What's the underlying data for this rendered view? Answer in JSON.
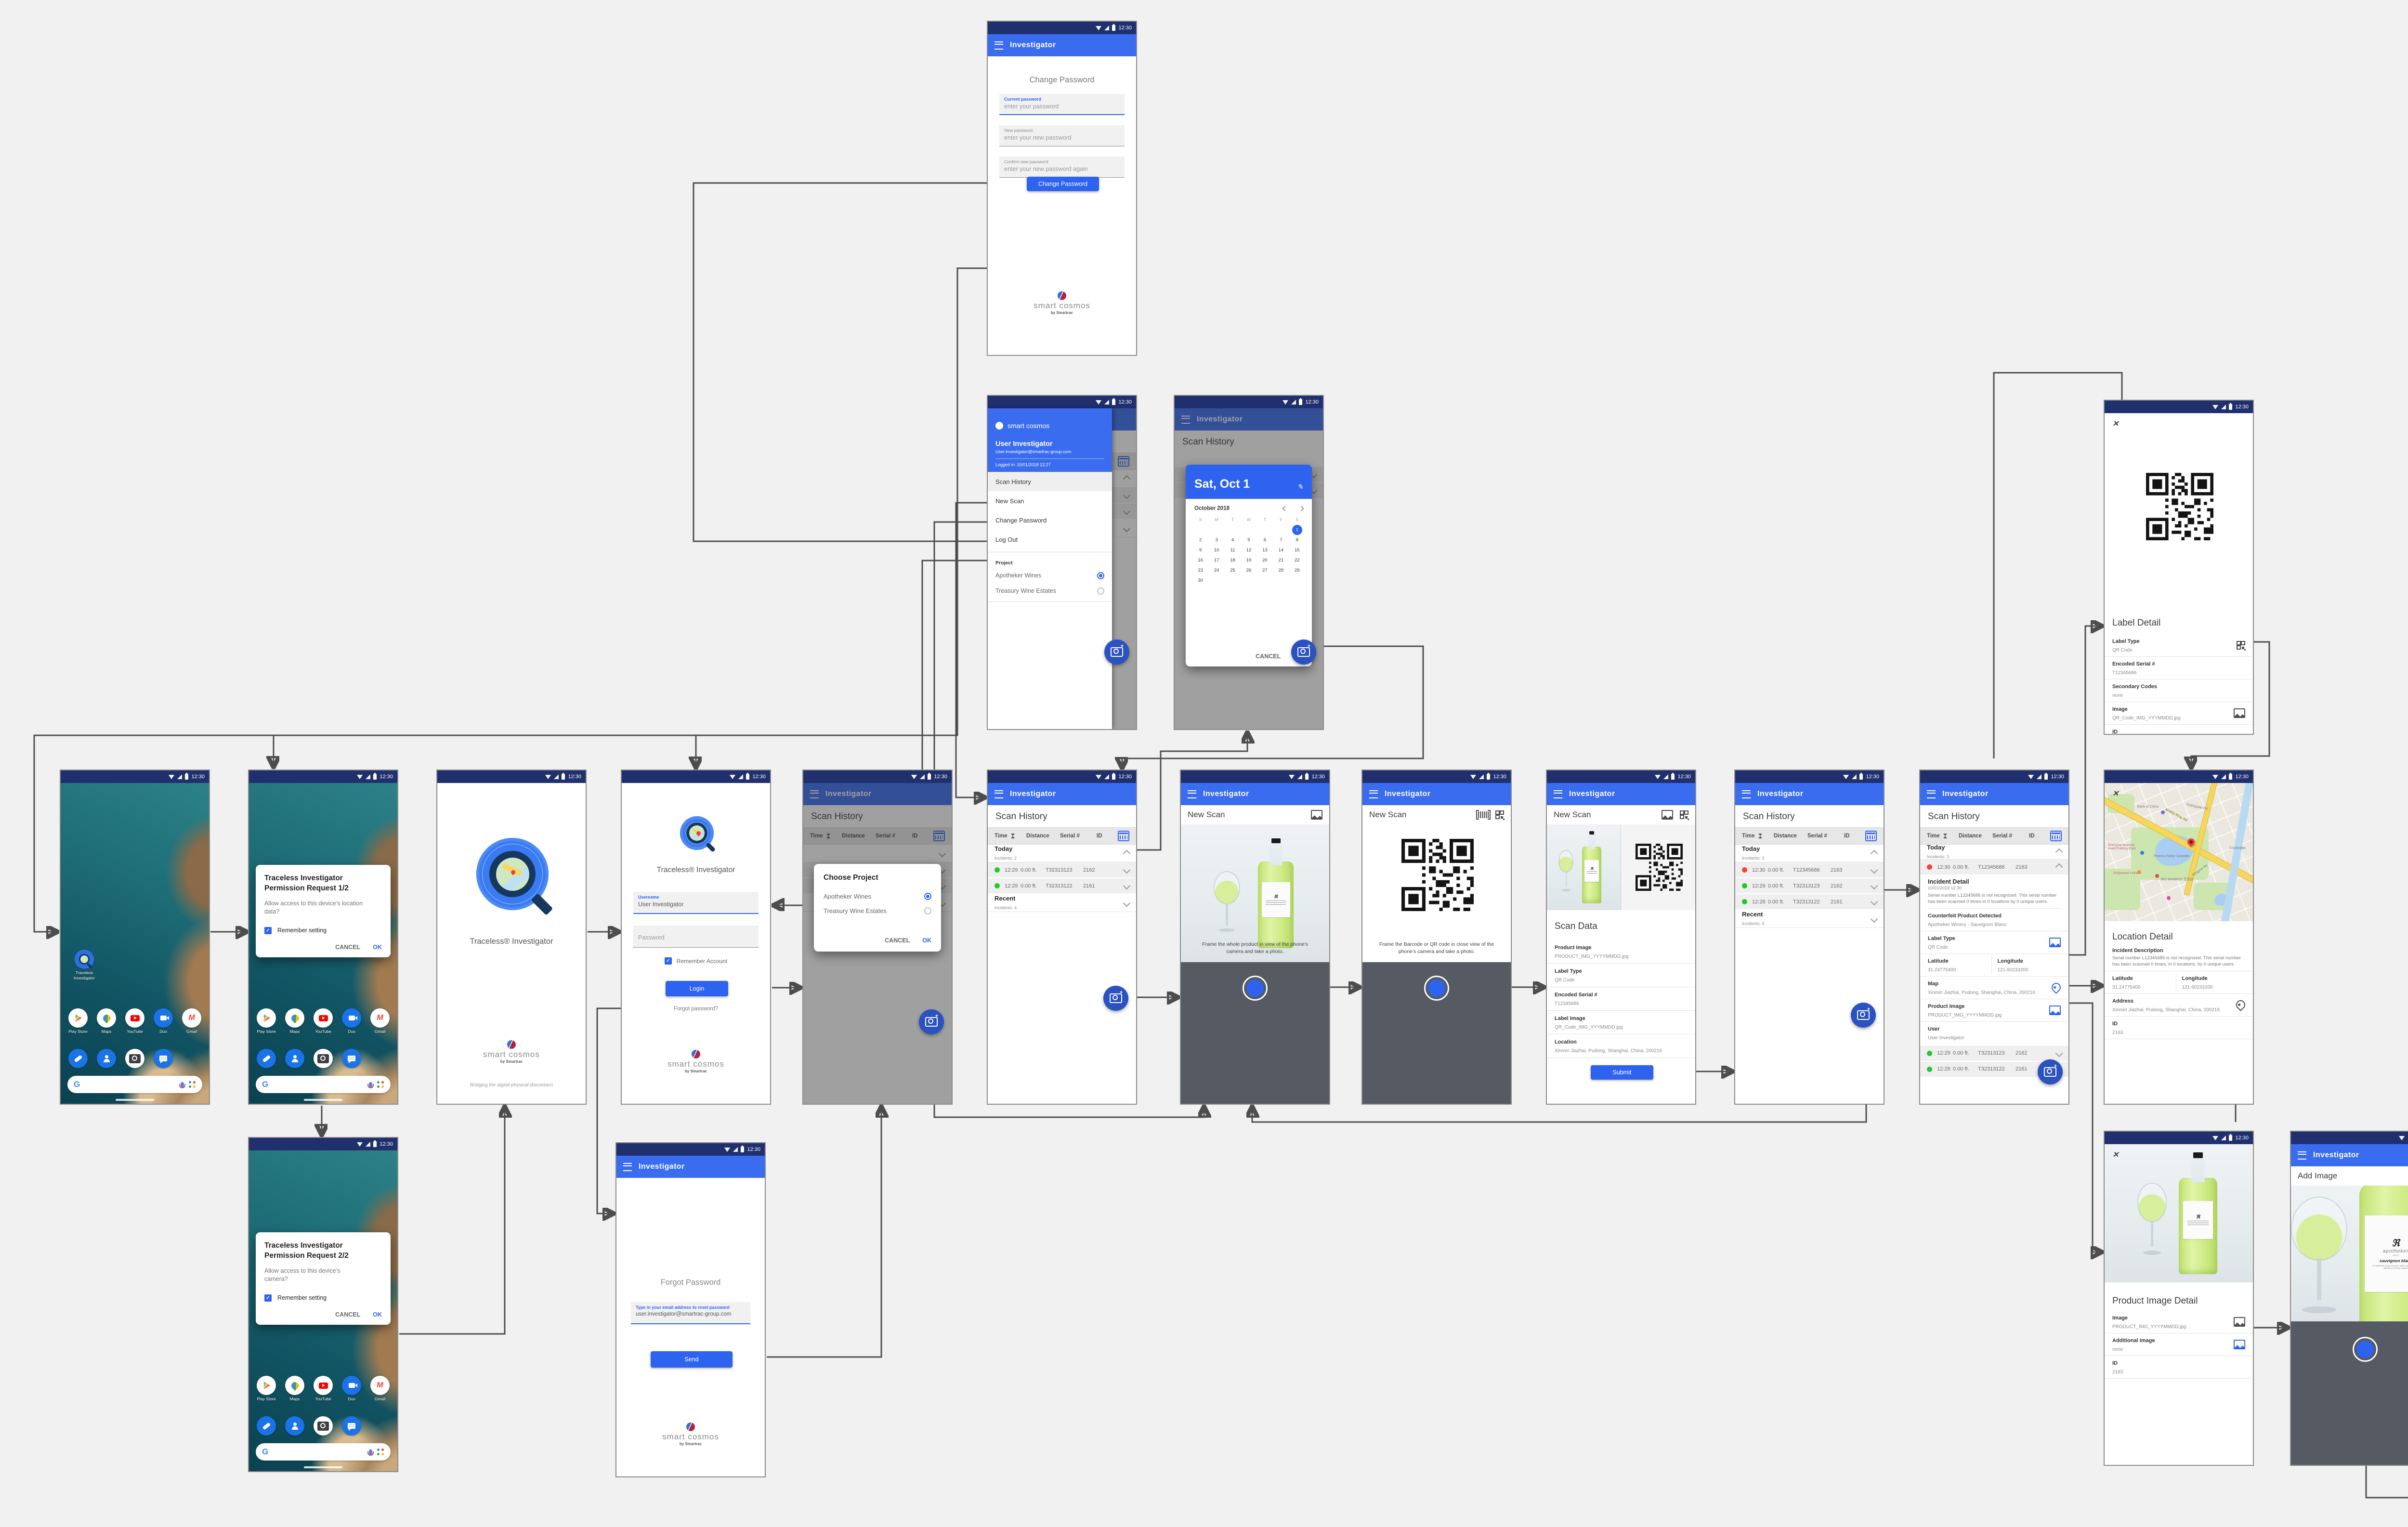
{
  "status": {
    "time": "12:30"
  },
  "app": {
    "title": "Investigator"
  },
  "brand": {
    "name": "smart cosmos",
    "sub": "by Smartrac"
  },
  "colors": {
    "accent": "#2e63f0",
    "appbar": "#3a6cf0",
    "statusbar": "#20306f",
    "fab": "#2a52c0",
    "ok_green": "#1ecb2e",
    "alert_red": "#f44236"
  },
  "home": {
    "app_icon_label": "Traceless Investigator",
    "apps": [
      {
        "name": "Play Store"
      },
      {
        "name": "Maps"
      },
      {
        "name": "YouTube"
      },
      {
        "name": "Duo"
      },
      {
        "name": "Gmail"
      }
    ]
  },
  "perm1": {
    "title": "Traceless Investigator Permission Request 1/2",
    "body": "Allow access to this device’s location data?",
    "remember": "Remember setting",
    "cancel": "CANCEL",
    "ok": "OK"
  },
  "perm2": {
    "title": "Traceless Investigator Permission Request 2/2",
    "body": "Allow access to this device’s camera?",
    "remember": "Remember setting",
    "cancel": "CANCEL",
    "ok": "OK"
  },
  "splash": {
    "app_name": "Traceless® Investigator",
    "tagline": "Bridging the digital-physical disconnect"
  },
  "login": {
    "app_name": "Traceless® Investigator",
    "username_label": "Username",
    "username_value": "User Investigator",
    "password_placeholder": "Password",
    "remember": "Remember Account",
    "login": "Login",
    "forgot": "Forgot password?"
  },
  "forgot": {
    "title": "Forgot Password",
    "email_label": "Type in your email address to reset password",
    "email_value": "user.investigator@smartrac-group.com",
    "send": "Send"
  },
  "project_dialog": {
    "title": "Choose Project",
    "options": [
      {
        "label": "Apotheker Wines",
        "selected": true
      },
      {
        "label": "Treasury Wine Estates",
        "selected": false
      }
    ],
    "cancel": "CANCEL",
    "ok": "OK"
  },
  "drawer": {
    "brand": "smart cosmos",
    "user": "User Investigator",
    "email": "User.Investigator@smartrac-group.com",
    "logged_in": "Logged in: 10/01/2018 12:27",
    "items": [
      {
        "label": "Scan History"
      },
      {
        "label": "New Scan"
      },
      {
        "label": "Change Password"
      },
      {
        "label": "Log Out"
      }
    ],
    "project_label": "Project",
    "projects": [
      {
        "label": "Apotheker Wines",
        "selected": true
      },
      {
        "label": "Treasury Wine Estates",
        "selected": false
      }
    ]
  },
  "datepicker": {
    "selected_date": "Sat, Oct 1",
    "month": "October 2018",
    "dow": [
      "S",
      "M",
      "T",
      "W",
      "T",
      "F",
      "S"
    ],
    "days": [
      {
        "d": ""
      },
      {
        "d": ""
      },
      {
        "d": ""
      },
      {
        "d": ""
      },
      {
        "d": ""
      },
      {
        "d": ""
      },
      {
        "d": "1",
        "sel": true
      },
      {
        "d": "2"
      },
      {
        "d": "3"
      },
      {
        "d": "4"
      },
      {
        "d": "5"
      },
      {
        "d": "6"
      },
      {
        "d": "7"
      },
      {
        "d": "8"
      },
      {
        "d": "9"
      },
      {
        "d": "10"
      },
      {
        "d": "11"
      },
      {
        "d": "12"
      },
      {
        "d": "13"
      },
      {
        "d": "14"
      },
      {
        "d": "15"
      },
      {
        "d": "16"
      },
      {
        "d": "17"
      },
      {
        "d": "18"
      },
      {
        "d": "19"
      },
      {
        "d": "20"
      },
      {
        "d": "21"
      },
      {
        "d": "22"
      },
      {
        "d": "23"
      },
      {
        "d": "24"
      },
      {
        "d": "25"
      },
      {
        "d": "26"
      },
      {
        "d": "27"
      },
      {
        "d": "28"
      },
      {
        "d": "29"
      },
      {
        "d": "30"
      },
      {
        "d": ""
      },
      {
        "d": ""
      },
      {
        "d": ""
      },
      {
        "d": ""
      },
      {
        "d": ""
      }
    ],
    "cancel": "CANCEL",
    "ok": "OK"
  },
  "backdrop": {
    "title": "Scan History",
    "col_time": "Time",
    "col_distance": "Distance",
    "col_serial": "Serial #",
    "col_id": "ID"
  },
  "scan_history_1": {
    "title": "Scan History",
    "col_time": "Time",
    "col_distance": "Distance",
    "col_serial": "Serial #",
    "col_id": "ID",
    "groups": [
      {
        "name": "Today",
        "sub": "Incidents: 2"
      },
      {
        "name": "Recent",
        "sub": "Incidents: 4"
      }
    ],
    "rows": [
      {
        "status": "green",
        "time": "12:29",
        "distance": "0.00 ft.",
        "serial": "T32313123",
        "id": "2162"
      },
      {
        "status": "green",
        "time": "12:29",
        "distance": "0.00 ft.",
        "serial": "T32313122",
        "id": "2161"
      }
    ]
  },
  "new_scan_product": {
    "title": "New Scan",
    "caption": "Frame the whole product in view of the phone’s camera and take a photo."
  },
  "new_scan_label": {
    "title": "New Scan",
    "caption": "Frame the Barcode or QR code in close view of the phone’s camera and take a photo."
  },
  "scan_data": {
    "title": "New Scan",
    "section": "Scan Data",
    "fields": [
      {
        "label": "Product Image",
        "value": "PRODUCT_IMG_YYYYMMDD.jpg"
      },
      {
        "label": "Label Type",
        "value": "QR Code"
      },
      {
        "label": "Encoded Serial #",
        "value": "T12345686"
      },
      {
        "label": "Label Image",
        "value": "QR_Code_IMG_YYYMMDD.jpg"
      },
      {
        "label": "Location",
        "value": "Xinmin Jiazhai, Pudong, Shanghai, China, 200216"
      }
    ],
    "submit": "Submit"
  },
  "scan_history_2": {
    "title": "Scan History",
    "col_time": "Time",
    "col_distance": "Distance",
    "col_serial": "Serial #",
    "col_id": "ID",
    "groups": [
      {
        "name": "Today",
        "sub": "Incidents: 3"
      },
      {
        "name": "Recent",
        "sub": "Incidents: 4"
      }
    ],
    "rows": [
      {
        "status": "red",
        "time": "12:30",
        "distance": "0.00 ft.",
        "serial": "T12345686",
        "id": "2163"
      },
      {
        "status": "green",
        "time": "12:29",
        "distance": "0.00 ft.",
        "serial": "T32313123",
        "id": "2162"
      },
      {
        "status": "green",
        "time": "12:28",
        "distance": "0.00 ft.",
        "serial": "T32313122",
        "id": "2161"
      }
    ]
  },
  "scan_history_3": {
    "title": "Scan History",
    "col_time": "Time",
    "col_distance": "Distance",
    "col_serial": "Serial #",
    "col_id": "ID",
    "group": {
      "name": "Today",
      "sub": "Incidents: 3"
    },
    "expanded_row": {
      "status": "red",
      "time": "12:30",
      "distance": "0.00 ft.",
      "serial": "T12345686",
      "id": "2163"
    },
    "incident": {
      "title": "Incident Detail",
      "date": "10/01/2018 12:30",
      "description": "Serial number L12345686 is not recognized. This serial number has been scanned 0 times in 0 locations by 0 unique users.",
      "counterfeit_label": "Counterfeit Product Detected",
      "counterfeit": "Apotheker Winery - Sauvignon Blanc",
      "label_type_label": "Label Type",
      "label_type": "QR Code",
      "lat_label": "Latitude",
      "lat": "31.24775400",
      "lng_label": "Longitude",
      "lng": "121.60233200",
      "map_label": "Map",
      "map": "Xinmin Jiazhai, Pudong, Shanghai, China, 200216",
      "product_image_label": "Product Image",
      "product_image": "PRODUCT_IMG_YYYYMMDD.jpg",
      "user_label": "User",
      "user": "User Investigator"
    },
    "rows": [
      {
        "status": "green",
        "time": "12:29",
        "distance": "0.00 ft.",
        "serial": "T32313123",
        "id": "2162"
      },
      {
        "status": "green",
        "time": "12:28",
        "distance": "0.00 ft.",
        "serial": "T32313122",
        "id": "2161"
      }
    ]
  },
  "label_detail": {
    "title": "Label Detail",
    "label_type_label": "Label Type",
    "label_type": "QR Code",
    "serial_label": "Encoded Serial #",
    "serial": "T12345686",
    "secondary_label": "Secondary Codes",
    "secondary": "none",
    "image_label": "Image",
    "image": "QR_Code_IMG_YYYMMDD.jpg",
    "id_label": "ID",
    "id": "2163"
  },
  "location_detail": {
    "title": "Location Detail",
    "incident_label": "Incident Description",
    "incident": "Serial number L12345686 is not recognized. This serial number has been scanned 0 times, in 0 locations, by 0 unique users.",
    "lat_label": "Latitude",
    "lat": "31.24775400",
    "lng_label": "Longitude",
    "lng": "121.60233200",
    "address_label": "Address",
    "address": "Xinmin Jiazhai, Pudong, Shanghai, China, 200216",
    "id_label": "ID",
    "id": "2163",
    "map": {
      "poi1": "Bank of China",
      "poi2": "Shanghai Marriott Hotel Pudong East",
      "poi3": "Thermo Fisher Scientific",
      "poi4": "Bollywood Indian",
      "poi5": "BIG BAMBOO 生活店",
      "road1": "Middle Ring Rd",
      "road2": "Xinjingqiao Rd",
      "road3": "Mingyue Rd",
      "road4": "Chuanqiao"
    }
  },
  "product_detail_1": {
    "title": "Product Image Detail",
    "image_label": "Image",
    "image": "PRODUCT_IMG_YYYYMMDD.jpg",
    "additional_label": "Additional Image",
    "additional": "none",
    "id_label": "ID",
    "id": "2163"
  },
  "add_image": {
    "title": "Add Image",
    "label": {
      "mark": "ℜ",
      "brand": "apotheker",
      "brand_sub": "winery",
      "wine": "sauvignon blanc",
      "fine": "an authentic Smart Cosmos select wine, 750 ml / alcohol 14.2% by volume"
    }
  },
  "product_detail_2": {
    "title": "Product Image Detail",
    "image_label": "Image",
    "image": "PRODUCT_IMG_YYYYMMDD.jpg",
    "secondary_label": "Secondary Image",
    "secondary": "PRODUCT_IMG_2_YYYYMMDD.jpg",
    "additional_label": "Additional Image",
    "additional": "none",
    "id_label": "ID",
    "id": "2163"
  },
  "change_password": {
    "title": "Change Password",
    "f1": {
      "label": "Current password",
      "value": "enter your password"
    },
    "f2": {
      "label": "New password",
      "value": "enter your new password"
    },
    "f3": {
      "label": "Confirm new password",
      "value": "enter your new password again"
    },
    "button": "Change Password"
  }
}
